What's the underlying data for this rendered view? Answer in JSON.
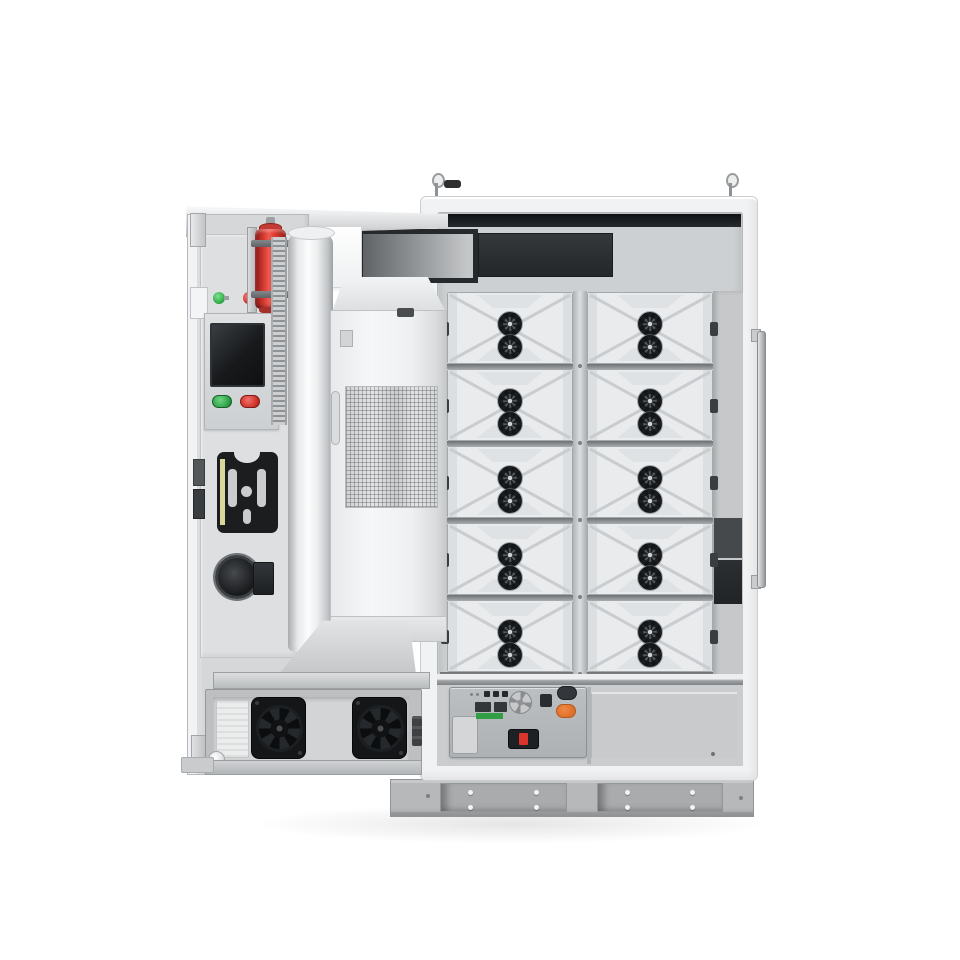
{
  "meta": {
    "description": "3D product render of an outdoor battery energy storage cabinet with its left door open",
    "visible_text": ""
  },
  "palette": {
    "cabinetFrame": "#f1f2f3",
    "interior": "#cdd0d2",
    "ventDark": "#26292c",
    "panelDark": "#24272a",
    "moduleFace": "#e9ebed",
    "moduleLine": "#c9cdcf",
    "moduleEdge": "#dcdfe1",
    "moduleBorder": "#a3a8ab",
    "fanDark": "#1b1e20",
    "fanBlade": "#55595c",
    "fanHub": "#d0d2d4",
    "doorFace": "#d5d7d9",
    "red": "#e23b33",
    "green": "#2faa47",
    "orange": "#dd6f28",
    "terminalGreen": "#2f9e45",
    "screenDark": "#17191b",
    "hvacBody": "#f6f7f8",
    "bigFan": "#141618",
    "base": "#b6b8ba",
    "baseRecess": "#a9abad",
    "ctrlFace": "#aeb1b3"
  },
  "cabinet": {
    "module_grid": {
      "columns": 2,
      "rows": 5,
      "fans_per_module": 2
    },
    "door_fan_count": 2,
    "base": {
      "panels": 2,
      "holes_per_panel": 4
    },
    "control_panel": {
      "led_count": 3
    }
  }
}
